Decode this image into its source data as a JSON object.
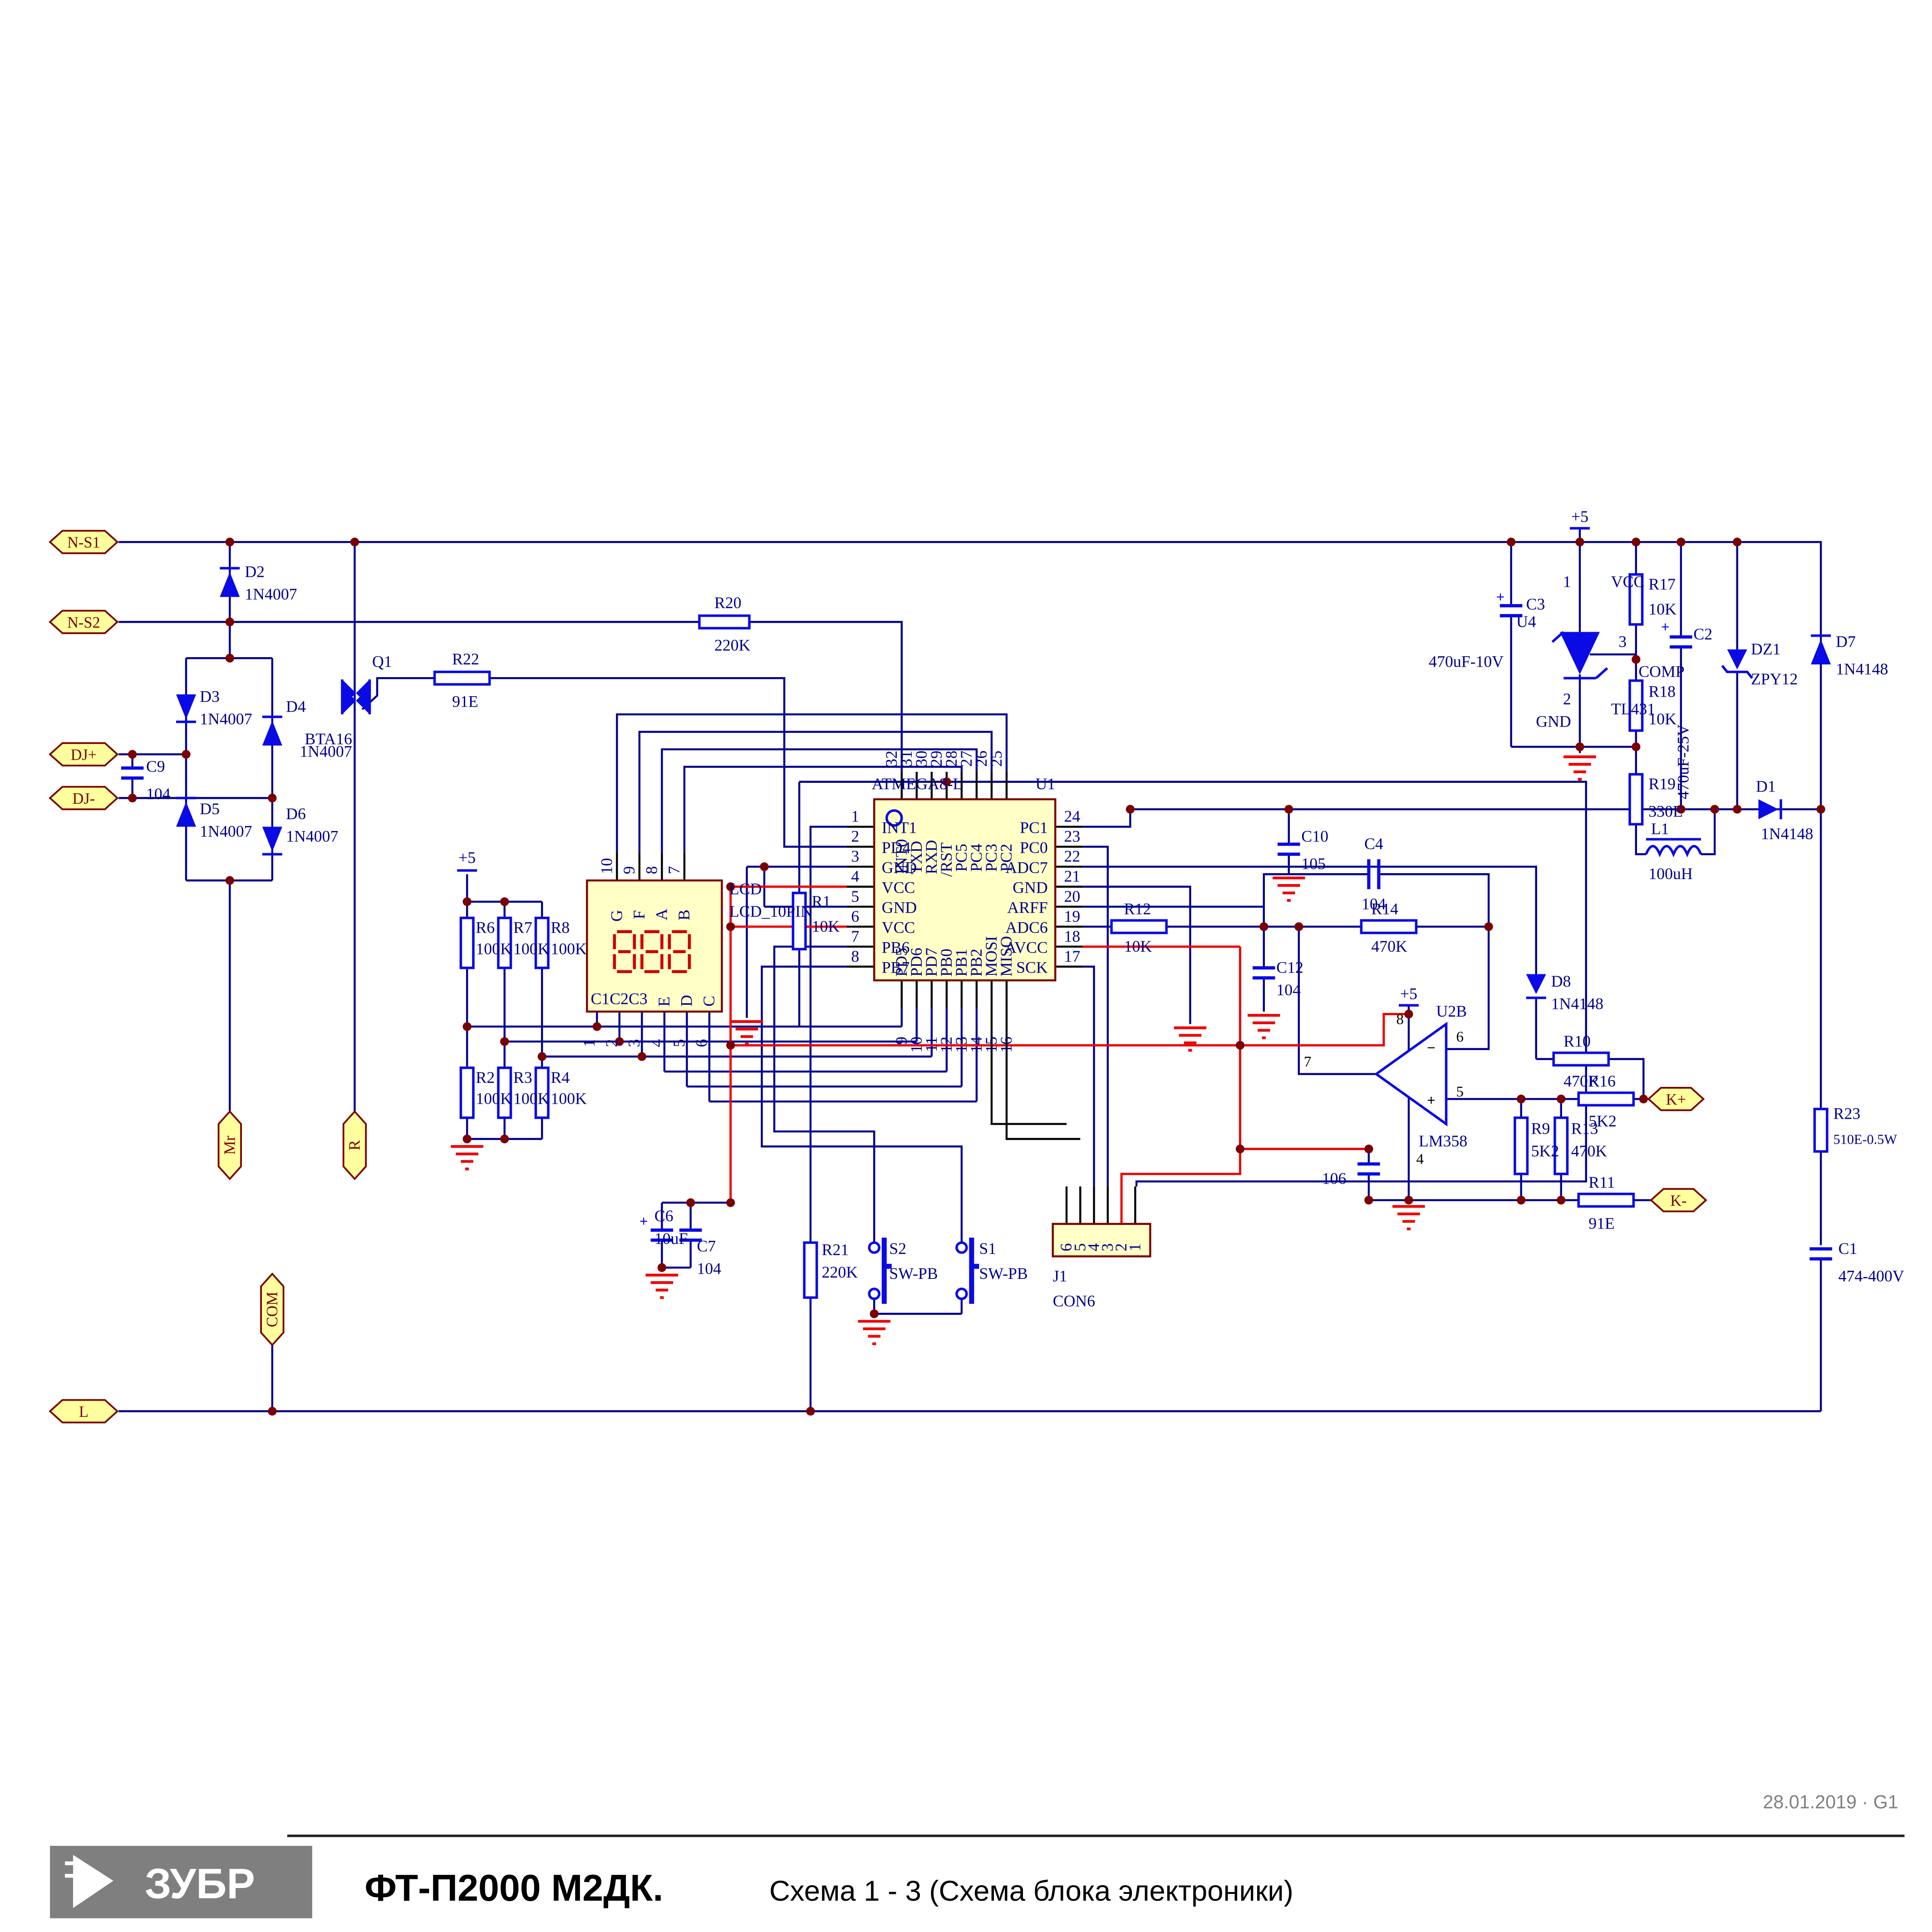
{
  "title": {
    "logo": "ЗУБР",
    "product": "ФТ-П2000 М2ДК.",
    "subtitle": "Схема 1 - 3 (Схема блока электроники)",
    "date": "28.01.2019 · G1"
  },
  "flags": {
    "ns1": "N-S1",
    "ns2": "N-S2",
    "djp": "DJ+",
    "djm": "DJ-",
    "mr": "Mr",
    "r": "R",
    "com": "COM",
    "l": "L",
    "kp": "K+",
    "km": "K-",
    "p5": "+5"
  },
  "parts": {
    "d2": {
      "ref": "D2",
      "val": "1N4007"
    },
    "d3": {
      "ref": "D3",
      "val": "1N4007"
    },
    "d4": {
      "ref": "D4",
      "val": "1N4007"
    },
    "d5": {
      "ref": "D5",
      "val": "1N4007"
    },
    "d6": {
      "ref": "D6",
      "val": "1N4007"
    },
    "c9": {
      "ref": "C9",
      "val": "104"
    },
    "q1": {
      "ref": "Q1",
      "val": "BTA16"
    },
    "r22": {
      "ref": "R22",
      "val": "91E"
    },
    "r20": {
      "ref": "R20",
      "val": "220K"
    },
    "r1": {
      "ref": "R1",
      "val": "10K"
    },
    "r21": {
      "ref": "R21",
      "val": "220K"
    },
    "r6": {
      "ref": "R6",
      "val": "100K"
    },
    "r7": {
      "ref": "R7",
      "val": "100K"
    },
    "r8": {
      "ref": "R8",
      "val": "100K"
    },
    "r2": {
      "ref": "R2",
      "val": "100K"
    },
    "r3": {
      "ref": "R3",
      "val": "100K"
    },
    "r4": {
      "ref": "R4",
      "val": "100K"
    },
    "c6": {
      "ref": "C6",
      "val": "10uF"
    },
    "c7": {
      "ref": "C7",
      "val": "104"
    },
    "s2": {
      "ref": "S2",
      "val": "SW-PB"
    },
    "s1": {
      "ref": "S1",
      "val": "SW-PB"
    },
    "c10": {
      "ref": "C10",
      "val": "105"
    },
    "c12": {
      "ref": "C12",
      "val": "104"
    },
    "c4": {
      "ref": "C4",
      "val": "104"
    },
    "r12": {
      "ref": "R12",
      "val": "10K"
    },
    "r14": {
      "ref": "R14",
      "val": "470K"
    },
    "d8": {
      "ref": "D8",
      "val": "1N4148"
    },
    "r10": {
      "ref": "R10",
      "val": "470K"
    },
    "r16": {
      "ref": "R16",
      "val": "5K2"
    },
    "r9": {
      "ref": "R9",
      "val": "5K2"
    },
    "r13": {
      "ref": "R13",
      "val": "470K"
    },
    "r11": {
      "ref": "R11",
      "val": "91E"
    },
    "c5": {
      "ref": "C5",
      "val": "106"
    },
    "c3": {
      "ref": "C3",
      "val": "470uF-10V"
    },
    "r17": {
      "ref": "R17",
      "val": "10K"
    },
    "r18": {
      "ref": "R18",
      "val": "10K"
    },
    "c2": {
      "ref": "C2",
      "val": "470uF-25V"
    },
    "dz1": {
      "ref": "DZ1",
      "val": "ZPY12"
    },
    "d7": {
      "ref": "D7",
      "val": "1N4148"
    },
    "r19": {
      "ref": "R19",
      "val": "330E"
    },
    "d1": {
      "ref": "D1",
      "val": "1N4148"
    },
    "l1": {
      "ref": "L1",
      "val": "100uH"
    },
    "r23": {
      "ref": "R23",
      "val": "510E-0.5W"
    },
    "c1": {
      "ref": "C1",
      "val": "474-400V"
    }
  },
  "j1": {
    "ref": "J1",
    "val": "CON6",
    "pins": [
      "6",
      "5",
      "4",
      "3",
      "2",
      "1"
    ]
  },
  "u1": {
    "ref": "U1",
    "part": "ATMEGA8-L",
    "top_nums": [
      "32",
      "31",
      "30",
      "29",
      "28",
      "27",
      "26",
      "25"
    ],
    "top_names": [
      "INT0",
      "TXD",
      "RXD",
      "/RST",
      "PC5",
      "PC4",
      "PC3",
      "PC2"
    ],
    "left_nums": [
      "1",
      "2",
      "3",
      "4",
      "5",
      "6",
      "7",
      "8"
    ],
    "left_names": [
      "INT1",
      "PD4",
      "GND",
      "VCC",
      "GND",
      "VCC",
      "PB6",
      "PB7"
    ],
    "right_nums": [
      "24",
      "23",
      "22",
      "21",
      "20",
      "19",
      "18",
      "17"
    ],
    "right_names": [
      "PC1",
      "PC0",
      "ADC7",
      "GND",
      "ARFF",
      "ADC6",
      "AVCC",
      "SCK"
    ],
    "bottom_nums": [
      "9",
      "10",
      "11",
      "12",
      "13",
      "14",
      "15",
      "16"
    ],
    "bottom_names": [
      "PD5",
      "PD6",
      "PD7",
      "PB0",
      "PB1",
      "PB2",
      "MOSI",
      "MISO"
    ]
  },
  "lcd": {
    "ref": "LCD",
    "part": "LCD_10PIN",
    "top_nums": [
      "10",
      "9",
      "8",
      "7"
    ],
    "top_names": [
      "G",
      "F",
      "A",
      "B"
    ],
    "bottom_nums": [
      "1",
      "2",
      "3",
      "4",
      "5",
      "6"
    ],
    "bottom_left": "C1C2C3",
    "bottom_names": [
      "E",
      "D",
      "C"
    ]
  },
  "u2": {
    "ref": "U2B",
    "val": "LM358",
    "p4": "4",
    "p5": "5",
    "p6": "6",
    "p7": "7",
    "p8": "8"
  },
  "u4": {
    "ref": "U4",
    "val": "TL431",
    "n1": "1",
    "n1l": "VCC",
    "n2": "2",
    "n2l": "GND",
    "n3": "3",
    "n3l": "COMP"
  }
}
